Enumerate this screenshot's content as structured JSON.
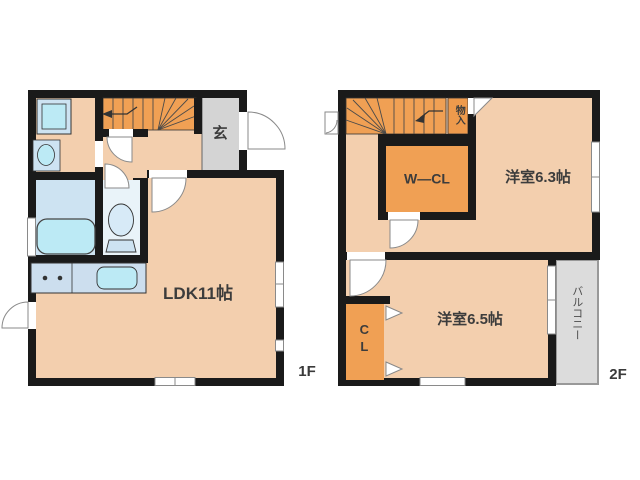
{
  "floor1": {
    "floor_label": "1F",
    "entrance_label": "玄",
    "ldk_label": "LDK11帖",
    "icon_names": [
      "stairs-icon",
      "washing-machine-icon",
      "vanity-basin-icon",
      "bathtub-icon",
      "toilet-icon",
      "stove-burners-icon",
      "kitchen-sink-icon",
      "door-swing-icon",
      "window-icon"
    ]
  },
  "floor2": {
    "floor_label": "2F",
    "storage_label": "物入",
    "walk_in_closet_label": "W—CL",
    "room_6_3_label": "洋室6.3帖",
    "room_6_5_label": "洋室6.5帖",
    "closet_label": "CL",
    "balcony_label": "バルコニー",
    "icon_names": [
      "stairs-icon",
      "door-swing-icon",
      "window-icon",
      "casement-window-icon",
      "closet-door-arrow-icon",
      "sliding-window-icon"
    ]
  },
  "colors": {
    "wall": "#1a1a1a",
    "room_floor": "#f3cfae",
    "stairs_and_closet_orange": "#f0a054",
    "entrance_gray": "#d4d4d4",
    "balcony_gray": "#dcdcdc",
    "fixture_blue": "#cde3f2",
    "fixture_aqua": "#bceaf5",
    "kitchen_counter_blue": "#ccdeee",
    "text": "#3c3c3c"
  }
}
